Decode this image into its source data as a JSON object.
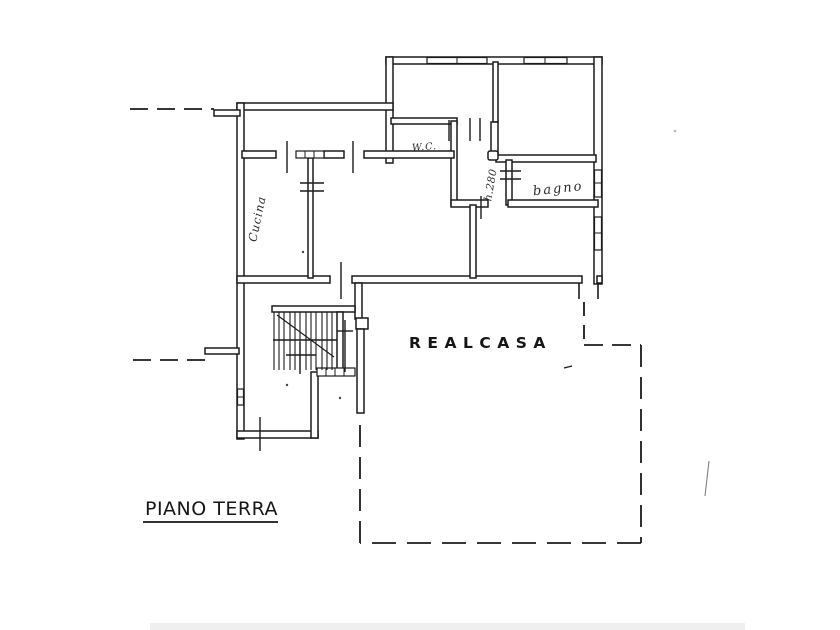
{
  "meta": {
    "drawing_type": "cadastral floor plan",
    "colors": {
      "ink": "#1b1b1b",
      "paper": "#ffffff"
    }
  },
  "labels": {
    "floor_title": "PIANO TERRA",
    "watermark": "REALCASA",
    "rooms": {
      "kitchen": "Cucina",
      "wc": "W.C.",
      "bathroom": "bagno",
      "ceiling_height_note": "h.280"
    }
  }
}
